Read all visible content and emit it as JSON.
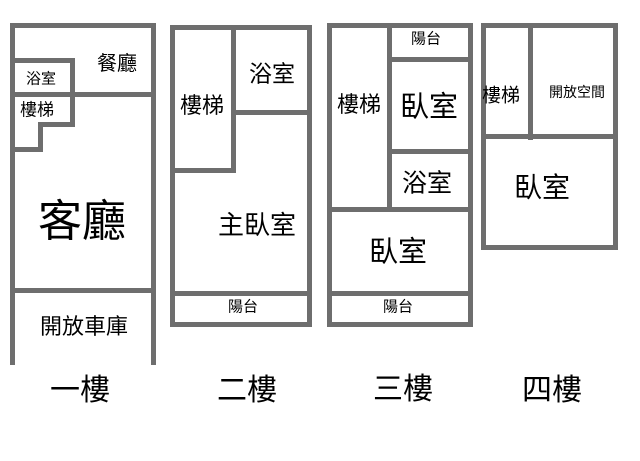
{
  "diagram_type": "floor-plan",
  "colors": {
    "wall": "#6e6e6e",
    "text": "#000000",
    "background": "#ffffff"
  },
  "floors": [
    {
      "name": "一樓",
      "rooms": {
        "dining": "餐廳",
        "bathroom": "浴室",
        "stairs": "樓梯",
        "living": "客廳",
        "garage": "開放車庫"
      }
    },
    {
      "name": "二樓",
      "rooms": {
        "stairs": "樓梯",
        "bathroom": "浴室",
        "master_bedroom": "主臥室",
        "balcony": "陽台"
      }
    },
    {
      "name": "三樓",
      "rooms": {
        "stairs": "樓梯",
        "balcony_top": "陽台",
        "bedroom_upper": "臥室",
        "bathroom": "浴室",
        "bedroom_lower": "臥室",
        "balcony_bottom": "陽台"
      }
    },
    {
      "name": "四樓",
      "rooms": {
        "stairs": "樓梯",
        "open_space": "開放空間",
        "bedroom": "臥室"
      }
    }
  ]
}
